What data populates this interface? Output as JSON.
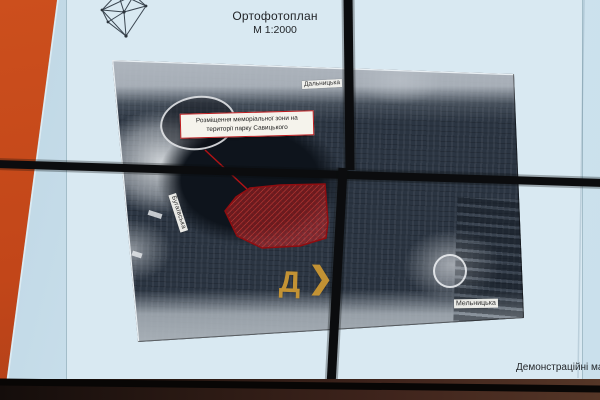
{
  "slide": {
    "title_line1": "Ортофотоплан",
    "title_line2": "М 1:2000",
    "footer_text": "Демонстраційні мате",
    "logo_icon": "city-wireframe-logo"
  },
  "map": {
    "annotation_line1": "Розміщення меморіальної зони на",
    "annotation_line2": "території парку Савицького",
    "streets": {
      "top": "Дальницька",
      "left": "Бугаївська",
      "bottom_right": "Мельницька"
    },
    "watermark_letter": "Д",
    "watermark_chevron": "❯"
  },
  "colors": {
    "screen_blue": "#cfe4ef",
    "wall_orange": "#c64c1d",
    "memorial_zone_red": "#c32222",
    "zone_border_red": "#8f0d10",
    "annotation_border_red": "#bd1d20",
    "watermark_orange": "#cf9a33",
    "bezel_black": "#0b0c0e"
  }
}
